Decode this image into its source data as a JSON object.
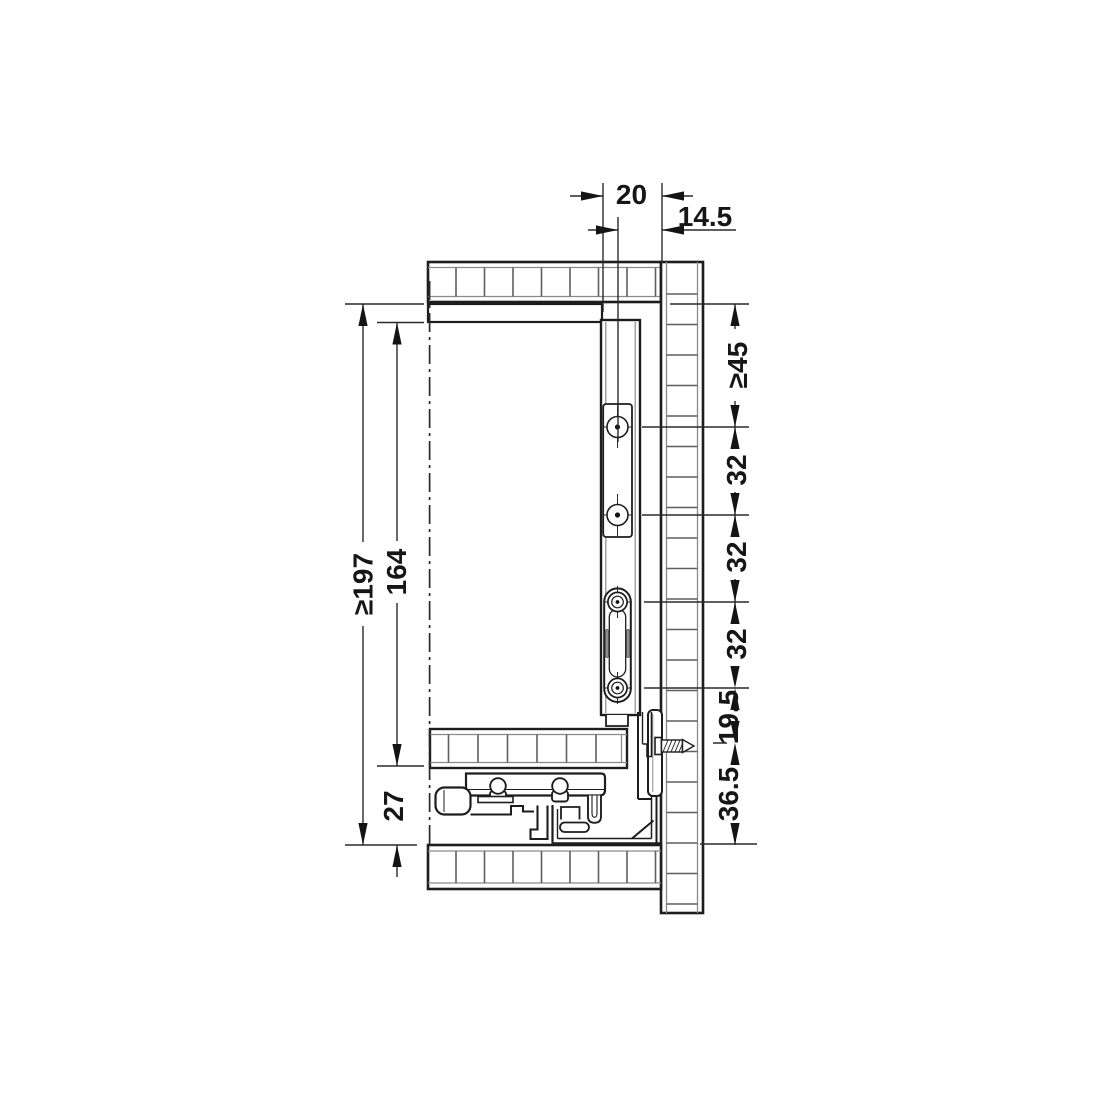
{
  "drawing": {
    "type": "installation-cross-section",
    "subject": "drawer rear mounting with system 32 hole line",
    "background": "#ffffff",
    "line_color": "#1d1d1d"
  },
  "dimensions": {
    "top": [
      {
        "id": "rear-gap",
        "label": "20"
      },
      {
        "id": "hole-axis-offset",
        "label": "14.5"
      }
    ],
    "left": [
      {
        "id": "min-total-height",
        "label": "≥197"
      },
      {
        "id": "rear-panel-height",
        "label": "164"
      },
      {
        "id": "bottom-clearance",
        "label": "27"
      }
    ],
    "right": [
      {
        "id": "min-top-distance",
        "label": "≥45"
      },
      {
        "id": "hole-pitch-1",
        "label": "32"
      },
      {
        "id": "hole-pitch-2",
        "label": "32"
      },
      {
        "id": "hole-pitch-3",
        "label": "32"
      },
      {
        "id": "screw-offset",
        "label": "19.5"
      },
      {
        "id": "bottom-offset",
        "label": "36.5"
      }
    ]
  },
  "symbols": [
    {
      "id": "centerline",
      "meaning": "reference axis (dash-dot)"
    },
    {
      "id": "hatched-panels",
      "meaning": "board cross-sections"
    },
    {
      "id": "screw",
      "meaning": "fixing screw into cabinet panel"
    }
  ]
}
